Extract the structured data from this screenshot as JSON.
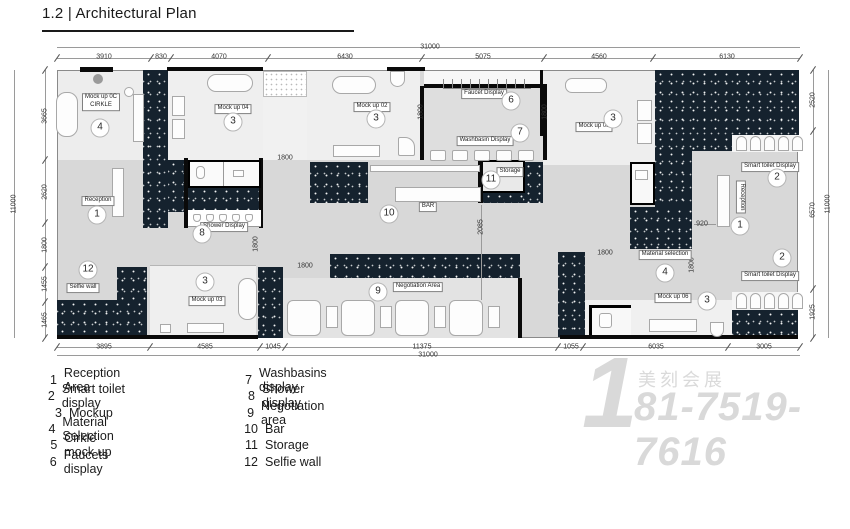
{
  "page": {
    "title": "1.2 | Architectural Plan"
  },
  "colors": {
    "wall_hatch": "#15222e",
    "floor_mid": "#d8d8d8",
    "floor_light": "#efefef",
    "watermark": "#d9d9d9"
  },
  "plan": {
    "dimensions": [
      {
        "text": "31000",
        "x": 430,
        "y": 47
      },
      {
        "text": "3910",
        "x": 104,
        "y": 57
      },
      {
        "text": "830",
        "x": 161,
        "y": 57
      },
      {
        "text": "4070",
        "x": 219,
        "y": 57
      },
      {
        "text": "6430",
        "x": 345,
        "y": 57
      },
      {
        "text": "5075",
        "x": 483,
        "y": 57
      },
      {
        "text": "4560",
        "x": 599,
        "y": 57
      },
      {
        "text": "6130",
        "x": 727,
        "y": 57
      },
      {
        "text": "3895",
        "x": 104,
        "y": 347
      },
      {
        "text": "4585",
        "x": 205,
        "y": 347
      },
      {
        "text": "1045",
        "x": 273,
        "y": 347
      },
      {
        "text": "11375",
        "x": 422,
        "y": 347
      },
      {
        "text": "1055",
        "x": 571,
        "y": 347
      },
      {
        "text": "6035",
        "x": 656,
        "y": 347
      },
      {
        "text": "3005",
        "x": 764,
        "y": 347
      },
      {
        "text": "31000",
        "x": 428,
        "y": 355
      },
      {
        "text": "3665",
        "x": 45,
        "y": 116,
        "rot": true
      },
      {
        "text": "2620",
        "x": 45,
        "y": 192,
        "rot": true
      },
      {
        "text": "1800",
        "x": 45,
        "y": 245,
        "rot": true
      },
      {
        "text": "1455",
        "x": 45,
        "y": 284,
        "rot": true
      },
      {
        "text": "1465",
        "x": 45,
        "y": 320,
        "rot": true
      },
      {
        "text": "11000",
        "x": 14,
        "y": 204,
        "rot": true
      },
      {
        "text": "2520",
        "x": 813,
        "y": 100,
        "rot": true
      },
      {
        "text": "6570",
        "x": 813,
        "y": 210,
        "rot": true
      },
      {
        "text": "1925",
        "x": 813,
        "y": 312,
        "rot": true
      },
      {
        "text": "11000",
        "x": 828,
        "y": 204,
        "rot": true
      },
      {
        "text": "1800",
        "x": 421,
        "y": 112,
        "rot": true
      },
      {
        "text": "1800",
        "x": 545,
        "y": 112,
        "rot": true
      },
      {
        "text": "1800",
        "x": 285,
        "y": 158
      },
      {
        "text": "1800",
        "x": 256,
        "y": 244,
        "rot": true
      },
      {
        "text": "1800",
        "x": 305,
        "y": 266
      },
      {
        "text": "1800",
        "x": 605,
        "y": 253
      },
      {
        "text": "1800",
        "x": 692,
        "y": 265,
        "rot": true
      },
      {
        "text": "920",
        "x": 702,
        "y": 224
      },
      {
        "text": "2085",
        "x": 481,
        "y": 227,
        "rot": true
      }
    ],
    "area_labels": [
      {
        "text": "Mock up 0C\nCIRKLE",
        "x": 101,
        "y": 102
      },
      {
        "text": "Mock up 04",
        "x": 233,
        "y": 109
      },
      {
        "text": "Mock up 02",
        "x": 372,
        "y": 107
      },
      {
        "text": "Faucet Display",
        "x": 484,
        "y": 94
      },
      {
        "text": "Washbasin Display",
        "x": 485,
        "y": 141
      },
      {
        "text": "Storage",
        "x": 510,
        "y": 172
      },
      {
        "text": "BAR",
        "x": 428,
        "y": 207
      },
      {
        "text": "Shower Display",
        "x": 224,
        "y": 227
      },
      {
        "text": "Reception",
        "x": 98,
        "y": 201
      },
      {
        "text": "Selfie wall",
        "x": 83,
        "y": 288
      },
      {
        "text": "Mock up 03",
        "x": 207,
        "y": 301
      },
      {
        "text": "Negotiation Area",
        "x": 418,
        "y": 287
      },
      {
        "text": "Mock up 05",
        "x": 594,
        "y": 127
      },
      {
        "text": "Smart toilet Display",
        "x": 770,
        "y": 167
      },
      {
        "text": "Smart toilet Display",
        "x": 770,
        "y": 276
      },
      {
        "text": "Material selection",
        "x": 665,
        "y": 255
      },
      {
        "text": "Mock up 06",
        "x": 673,
        "y": 298
      },
      {
        "text": "Reception",
        "x": 741,
        "y": 197,
        "vertical": true
      }
    ],
    "markers": [
      {
        "n": "4",
        "x": 100,
        "y": 128
      },
      {
        "n": "3",
        "x": 233,
        "y": 122
      },
      {
        "n": "3",
        "x": 376,
        "y": 119
      },
      {
        "n": "6",
        "x": 511,
        "y": 101
      },
      {
        "n": "7",
        "x": 520,
        "y": 133
      },
      {
        "n": "11",
        "x": 491,
        "y": 180
      },
      {
        "n": "10",
        "x": 389,
        "y": 214
      },
      {
        "n": "8",
        "x": 202,
        "y": 234
      },
      {
        "n": "1",
        "x": 97,
        "y": 215
      },
      {
        "n": "12",
        "x": 88,
        "y": 270
      },
      {
        "n": "3",
        "x": 205,
        "y": 282
      },
      {
        "n": "9",
        "x": 378,
        "y": 292
      },
      {
        "n": "3",
        "x": 613,
        "y": 119
      },
      {
        "n": "2",
        "x": 777,
        "y": 178
      },
      {
        "n": "1",
        "x": 740,
        "y": 226
      },
      {
        "n": "2",
        "x": 782,
        "y": 258
      },
      {
        "n": "4",
        "x": 665,
        "y": 273
      },
      {
        "n": "3",
        "x": 707,
        "y": 301
      }
    ]
  },
  "legend": {
    "columns": [
      [
        {
          "n": "1",
          "label": "Reception Area"
        },
        {
          "n": "2",
          "label": "Smart toilet display"
        },
        {
          "n": "3",
          "label": "Mockup"
        },
        {
          "n": "4",
          "label": "Material Selection"
        },
        {
          "n": "5",
          "label": "Cirkle mock up"
        },
        {
          "n": "6",
          "label": "Faucets display"
        }
      ],
      [
        {
          "n": "7",
          "label": "Washbasins display"
        },
        {
          "n": "8",
          "label": "Shower display"
        },
        {
          "n": "9",
          "label": "Negotiation area"
        },
        {
          "n": "10",
          "label": "Bar"
        },
        {
          "n": "11",
          "label": "Storage"
        },
        {
          "n": "12",
          "label": "Selfie wall"
        }
      ]
    ]
  },
  "watermark": {
    "big_digit": "1",
    "brand": "美刻会展",
    "phone": "81-7519-7616"
  }
}
